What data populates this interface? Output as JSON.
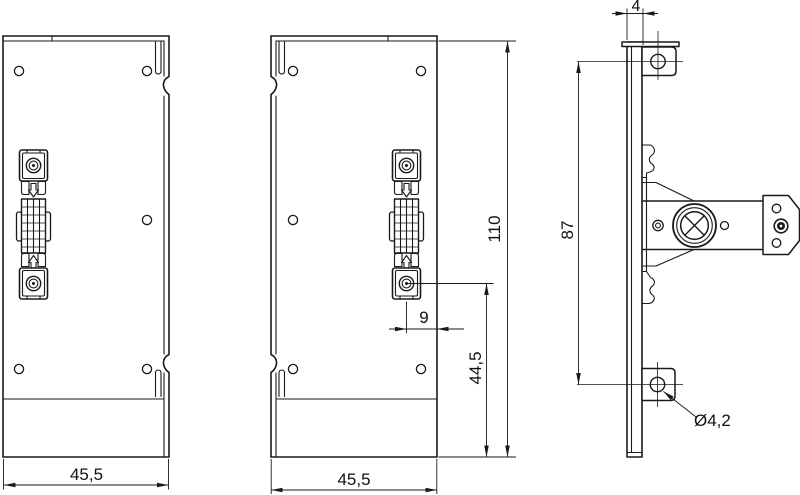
{
  "drawing": {
    "type": "technical-three-view-drawing",
    "colors": {
      "background": "#ffffff",
      "line": "#1a1a1a"
    },
    "dimensions": {
      "left_view_width": "45,5",
      "middle_view_width": "45,5",
      "total_height": "110",
      "latch_to_bottom": "44,5",
      "latch_offset": "9",
      "hole_spacing": "87",
      "panel_thickness": "4",
      "hole_diameter": "Ø4,2"
    }
  }
}
